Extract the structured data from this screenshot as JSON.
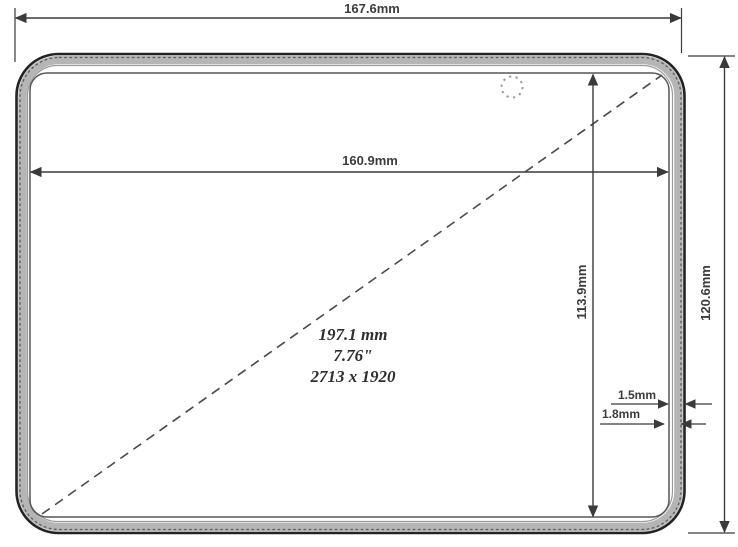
{
  "drawing": {
    "labels": {
      "outer_width": "167.6mm",
      "display_width": "160.9mm",
      "outer_height": "120.6mm",
      "display_height": "113.9mm",
      "bezel_outer": "1.5mm",
      "bezel_inner": "1.8mm",
      "diagonal_mm": "197.1 mm",
      "diagonal_inch": "7.76\"",
      "resolution": "2713 x 1920"
    },
    "colors": {
      "line": "#3a3a3a",
      "device_edge": "#222222",
      "band_gray": "#b5b5b5",
      "background": "#ffffff"
    }
  }
}
